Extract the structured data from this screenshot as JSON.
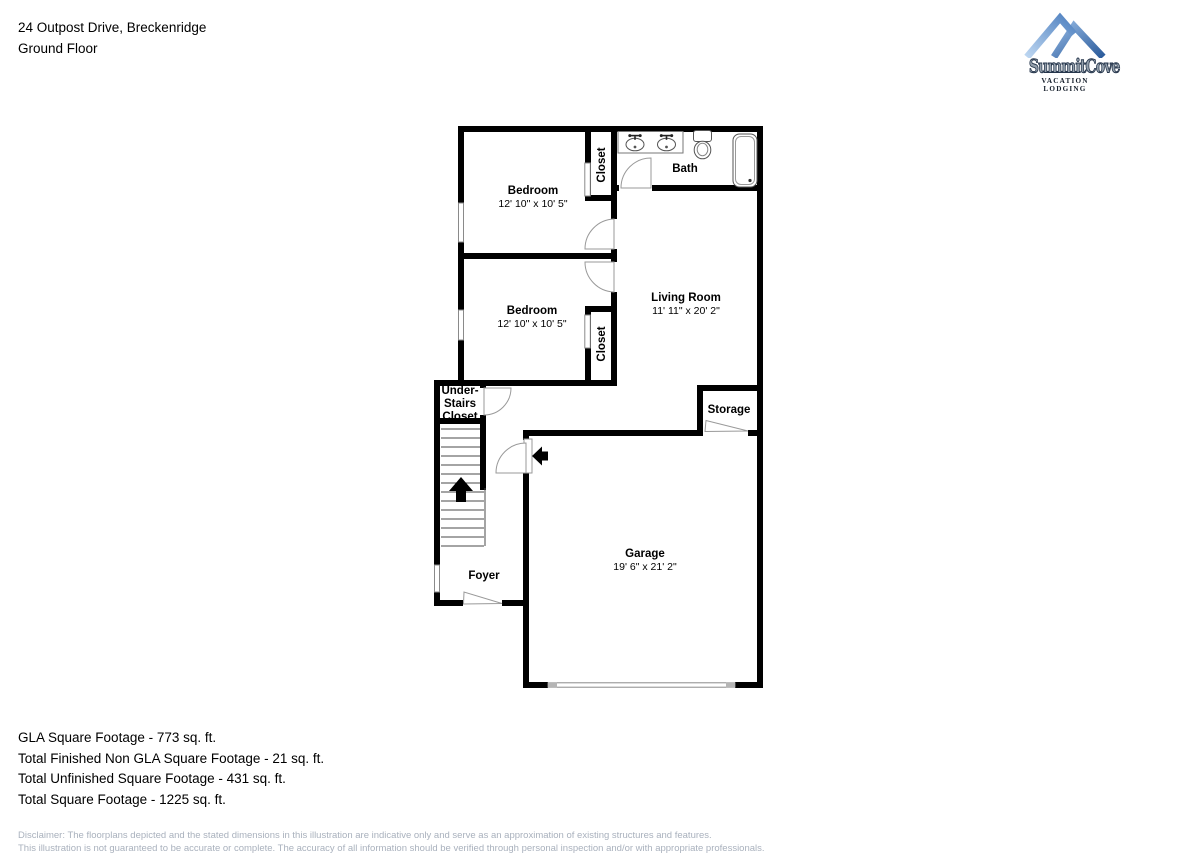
{
  "header": {
    "address": "24 Outpost Drive, Breckenridge",
    "floor": "Ground Floor"
  },
  "logo": {
    "brand": "SummitCove",
    "tagline": "VACATION LODGING",
    "mountain_light_color": "#4f81c0",
    "mountain_dark_color": "#2b5b9b"
  },
  "rooms": {
    "bedroom_top": {
      "name": "Bedroom",
      "dims": "12' 10\" x 10' 5\""
    },
    "closet_top": {
      "name": "Closet"
    },
    "bath": {
      "name": "Bath"
    },
    "bedroom_middle": {
      "name": "Bedroom",
      "dims": "12' 10\" x 10' 5\""
    },
    "living_room": {
      "name": "Living Room",
      "dims": "11' 11\" x 20' 2\""
    },
    "closet_middle": {
      "name": "Closet"
    },
    "under_stairs_closet": {
      "line1": "Under-",
      "line2": "Stairs",
      "line3": "Closet"
    },
    "storage": {
      "name": "Storage"
    },
    "foyer": {
      "name": "Foyer"
    },
    "garage": {
      "name": "Garage",
      "dims": "19' 6\" x 21' 2\""
    }
  },
  "footer": {
    "gla": "GLA Square Footage - 773 sq. ft.",
    "finished_non_gla": "Total Finished Non GLA Square Footage - 21 sq. ft.",
    "unfinished": "Total Unfinished Square Footage - 431 sq. ft.",
    "total": "Total Square Footage - 1225 sq. ft."
  },
  "disclaimer": {
    "line1": "Disclaimer: The floorplans depicted and the stated dimensions in this illustration are indicative only and serve as an approximation of existing structures and features.",
    "line2": "This illustration is not guaranteed to be accurate or complete. The accuracy of all information should be verified through personal inspection and/or with appropriate professionals."
  }
}
